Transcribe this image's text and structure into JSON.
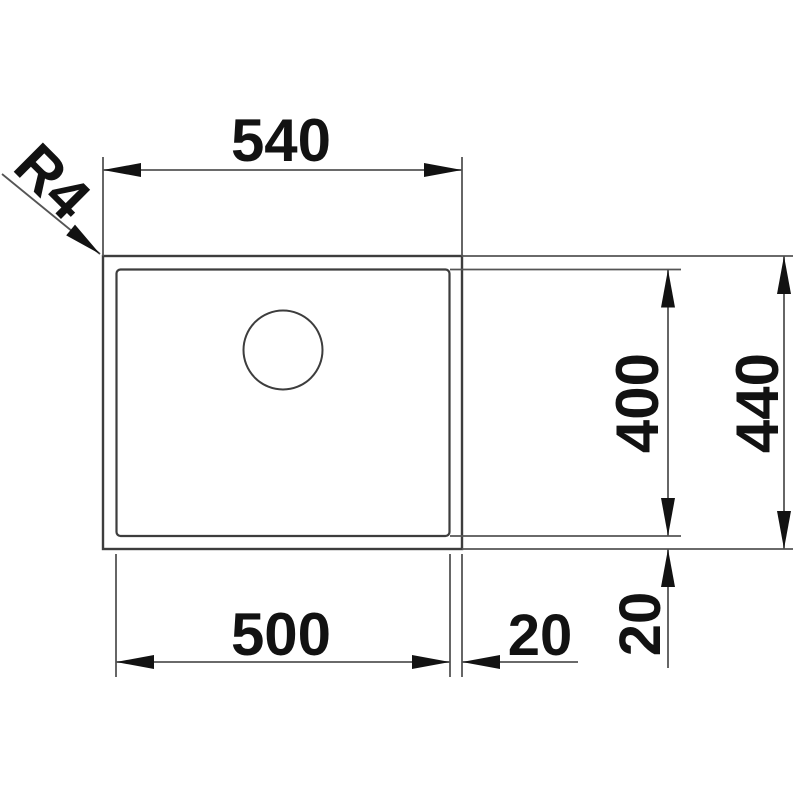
{
  "drawing": {
    "labels": {
      "outer_width": "540",
      "inner_width": "500",
      "inner_depth": "400",
      "outer_depth": "440",
      "rim_bottom": "20",
      "rim_right": "20",
      "corner_radius": "R4"
    },
    "colors": {
      "outline_stroke": "#3d3d3d",
      "dimension_stroke": "#555555",
      "text": "#121212",
      "background": "#ffffff"
    }
  }
}
